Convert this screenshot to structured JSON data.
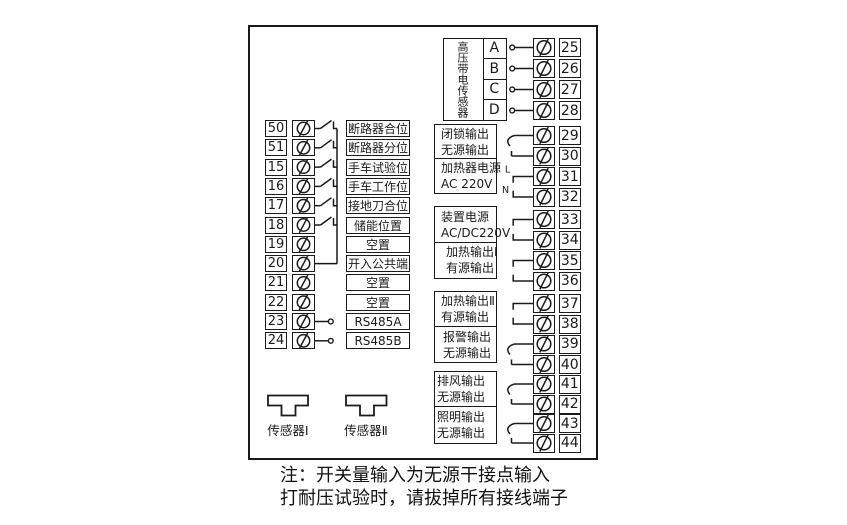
{
  "diagram": {
    "colors": {
      "line": "#1a1a1a",
      "background": "#ffffff"
    },
    "left_rows": [
      {
        "terminal": "50",
        "label": "断路器合位",
        "wire": "switch"
      },
      {
        "terminal": "51",
        "label": "断路器分位",
        "wire": "switch"
      },
      {
        "terminal": "15",
        "label": "手车试验位",
        "wire": "switch"
      },
      {
        "terminal": "16",
        "label": "手车工作位",
        "wire": "switch"
      },
      {
        "terminal": "17",
        "label": "接地刀合位",
        "wire": "switch"
      },
      {
        "terminal": "18",
        "label": "储能位置",
        "wire": "switch"
      },
      {
        "terminal": "19",
        "label": "空置",
        "wire": "none"
      },
      {
        "terminal": "20",
        "label": "开入公共端",
        "wire": "common"
      },
      {
        "terminal": "21",
        "label": "空置",
        "wire": "none"
      },
      {
        "terminal": "22",
        "label": "空置",
        "wire": "none"
      },
      {
        "terminal": "23",
        "label": "RS485A",
        "wire": "stub"
      },
      {
        "terminal": "24",
        "label": "RS485B",
        "wire": "stub"
      }
    ],
    "hv_group": {
      "label": "高压带电传感器",
      "channels": [
        {
          "name": "A",
          "terminal": "25"
        },
        {
          "name": "B",
          "terminal": "26"
        },
        {
          "name": "C",
          "terminal": "27"
        },
        {
          "name": "D",
          "terminal": "28"
        }
      ]
    },
    "output_groups": [
      {
        "cells": [
          {
            "lines": [
              "闭锁输出",
              "无源输出"
            ],
            "terminals": [
              "29",
              "30"
            ],
            "wire": "contact",
            "align": "left"
          },
          {
            "lines": [
              "加热器电源",
              "AC 220V"
            ],
            "terminals": [
              "31",
              "32"
            ],
            "wire": "bracket",
            "wire_labels": [
              "L",
              "N"
            ],
            "align": "left"
          }
        ]
      },
      {
        "cells": [
          {
            "lines": [
              "装置电源",
              "AC/DC220V"
            ],
            "terminals": [
              "33",
              "34"
            ],
            "wire": "bracket",
            "align": "left"
          },
          {
            "lines": [
              "加热输出Ⅰ",
              "有源输出"
            ],
            "terminals": [
              "35",
              "36"
            ],
            "wire": "bracket",
            "align": "left-indent"
          }
        ]
      },
      {
        "cells": [
          {
            "lines": [
              "加热输出Ⅱ",
              "有源输出"
            ],
            "terminals": [
              "37",
              "38"
            ],
            "wire": "bracket",
            "align": "left"
          },
          {
            "lines": [
              "报警输出",
              "无源输出"
            ],
            "terminals": [
              "39",
              "40"
            ],
            "wire": "contact",
            "align": "right"
          }
        ]
      },
      {
        "cells": [
          {
            "lines": [
              "排风输出",
              "无源输出"
            ],
            "terminals": [
              "41",
              "42"
            ],
            "wire": "contact",
            "align": "right-indent"
          },
          {
            "lines": [
              "照明输出",
              "无源输出"
            ],
            "terminals": [
              "43",
              "44"
            ],
            "wire": "contact",
            "align": "right-indent"
          }
        ]
      }
    ],
    "sensors": [
      {
        "label": "传感器Ⅰ"
      },
      {
        "label": "传感器Ⅱ"
      }
    ],
    "note_lines": [
      "注：开关量输入为无源干接点输入",
      "打耐压试验时，请拔掉所有接线端子"
    ]
  }
}
